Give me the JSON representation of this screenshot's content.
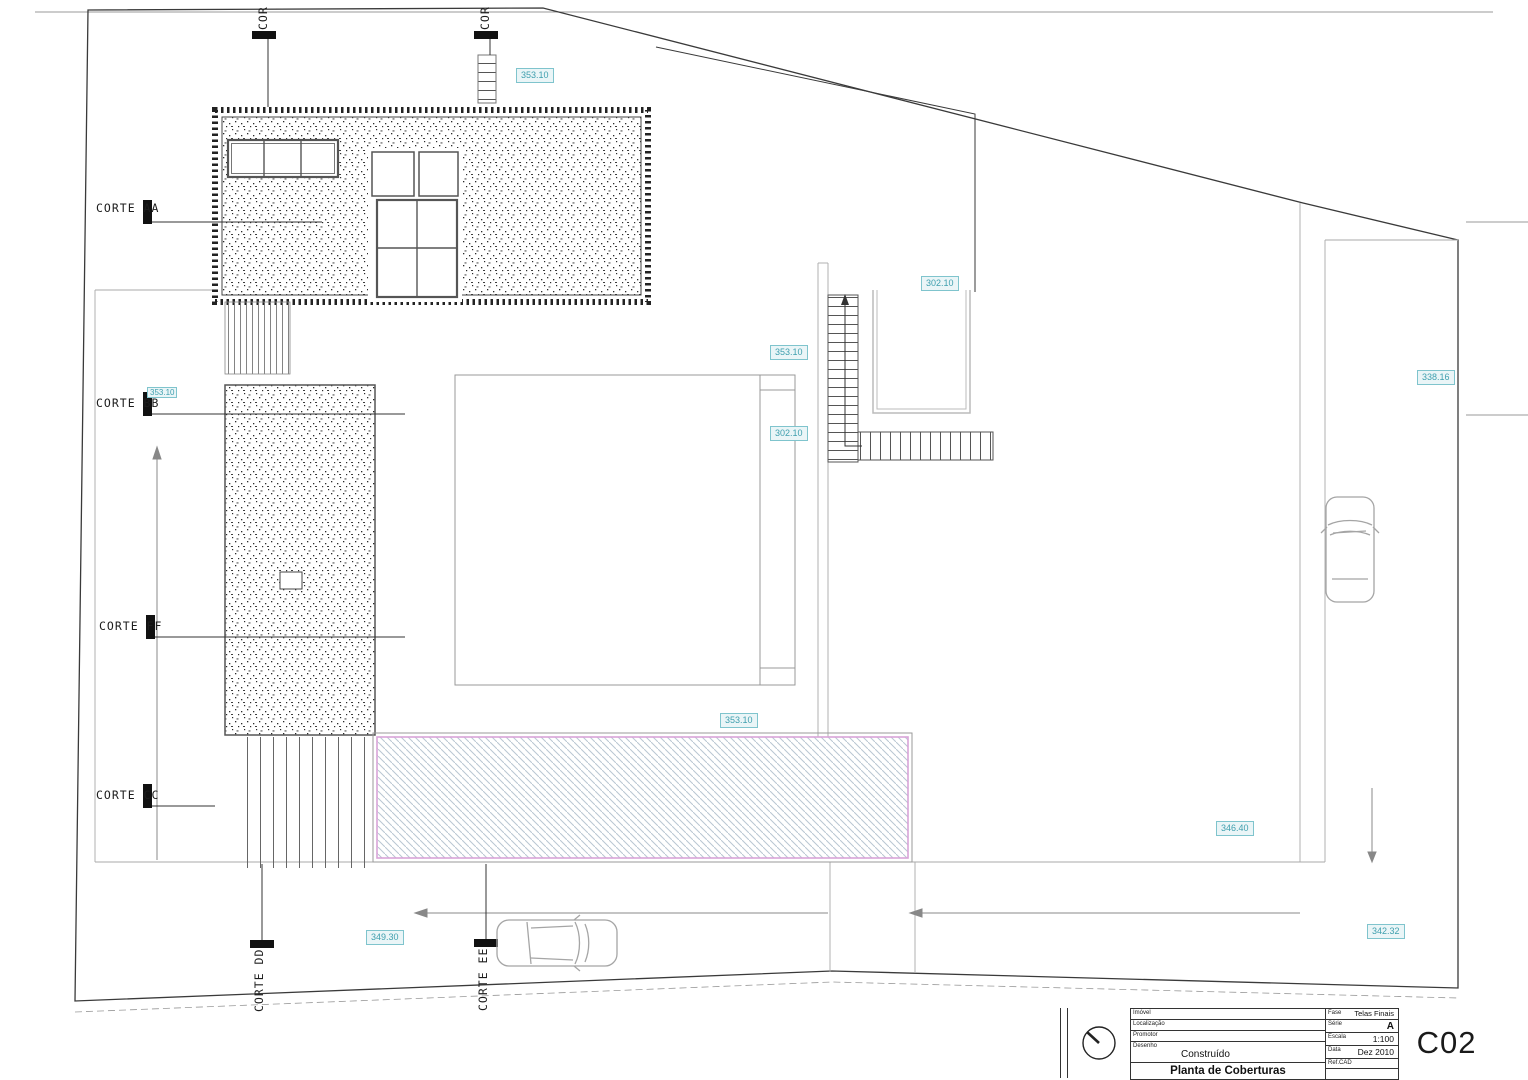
{
  "colors": {
    "line_dark": "#2f2f2f",
    "line_light": "#a8a8a8",
    "badge_text": "#3f9fae",
    "badge_fill": "#eaf5f7",
    "badge_border": "#7fc4cd",
    "pool_border": "#d8a4d8",
    "pool_hatch": "#b9c6d2"
  },
  "sections": {
    "aa": "CORTE AA",
    "bb": "CORTE BB",
    "ff": "CORTE FF",
    "cc": "CORTE CC",
    "dd": "CORTE DD",
    "ee": "CORTE EE",
    "dd_top": "COR",
    "ee_top": "COR"
  },
  "elevations": {
    "roof_top": "353.10",
    "courtyard_upper": "302.10",
    "terrace_upper": "353.10",
    "courtyard_lower": "302.10",
    "corte_bb_level": "353.10",
    "garden_right": "338.16",
    "pool_deck": "353.10",
    "patio_right": "346.40",
    "street_right": "342.32",
    "street_left": "349.30"
  },
  "title_block": {
    "sheet_code": "C02",
    "drawing_title": "Planta de Coberturas",
    "fields_left": [
      {
        "label": "Imóvel",
        "value": ""
      },
      {
        "label": "Localização",
        "value": ""
      },
      {
        "label": "Promotor",
        "value": ""
      },
      {
        "label": "Desenho",
        "value": "Construído"
      }
    ],
    "fields_right": [
      {
        "label": "Fase",
        "value": "Telas Finais"
      },
      {
        "label": "Série",
        "value": "A"
      },
      {
        "label": "Escala",
        "value": "1:100"
      },
      {
        "label": "Data",
        "value": "Dez 2010"
      },
      {
        "label": "Ref.CAD",
        "value": ""
      }
    ]
  }
}
